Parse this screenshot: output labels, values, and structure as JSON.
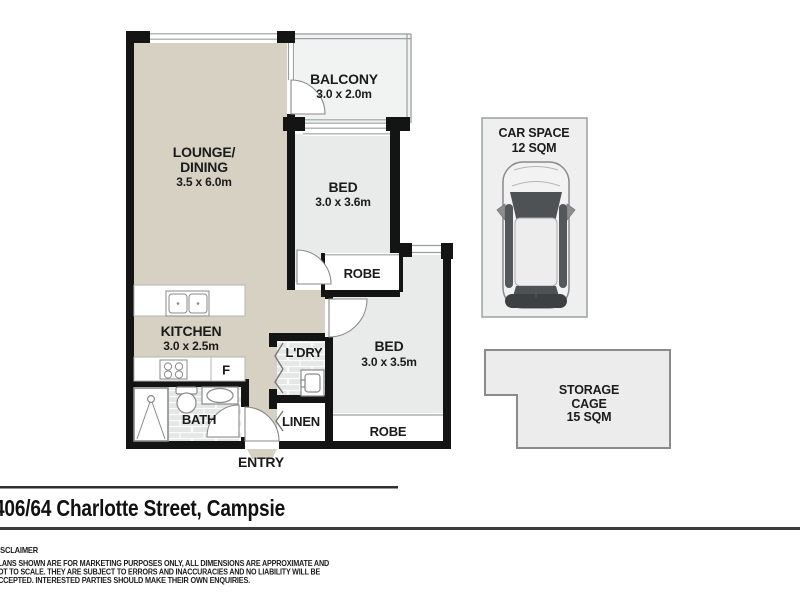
{
  "floorplan": {
    "rooms": {
      "lounge_dining": {
        "name_line1": "LOUNGE/",
        "name_line2": "DINING",
        "dims": "3.5 x 6.0m"
      },
      "balcony": {
        "name": "BALCONY",
        "dims": "3.0 x 2.0m"
      },
      "bed1": {
        "name": "BED",
        "dims": "3.0 x 3.6m"
      },
      "bed2": {
        "name": "BED",
        "dims": "3.0 x 3.5m"
      },
      "kitchen": {
        "name": "KITCHEN",
        "dims": "3.0 x 2.5m"
      },
      "bath": {
        "name": "BATH"
      },
      "laundry": {
        "name": "L'DRY"
      },
      "linen": {
        "name": "LINEN"
      },
      "robe_bed1": {
        "name": "ROBE"
      },
      "robe_bed2": {
        "name": "ROBE"
      },
      "entry": {
        "name": "ENTRY"
      },
      "fridge_label": "F"
    },
    "car_space": {
      "title": "CAR SPACE",
      "area": "12 SQM"
    },
    "storage_cage": {
      "line1": "STORAGE",
      "line2": "CAGE",
      "line3": "15 SQM"
    },
    "colors": {
      "floor_beige": "#d7d1c3",
      "floor_room_gray": "#e9eaea",
      "floor_balcony_gray": "#f1f2f2",
      "wall_black": "#141414",
      "car_space_fill": "#efefef",
      "storage_fill": "#ececec"
    }
  },
  "footer": {
    "address": "406/64 Charlotte Street, Campsie",
    "disclaimer_heading": "DISCLAIMER",
    "disclaimer_lines": [
      "PLANS SHOWN ARE FOR MARKETING PURPOSES ONLY, ALL DIMENSIONS ARE APPROXIMATE AND",
      "NOT TO SCALE. THEY ARE SUBJECT TO ERRORS AND INACCURACIES AND NO LIABILITY WILL BE",
      "ACCEPTED. INTERESTED PARTIES SHOULD MAKE THEIR OWN ENQUIRIES."
    ]
  }
}
